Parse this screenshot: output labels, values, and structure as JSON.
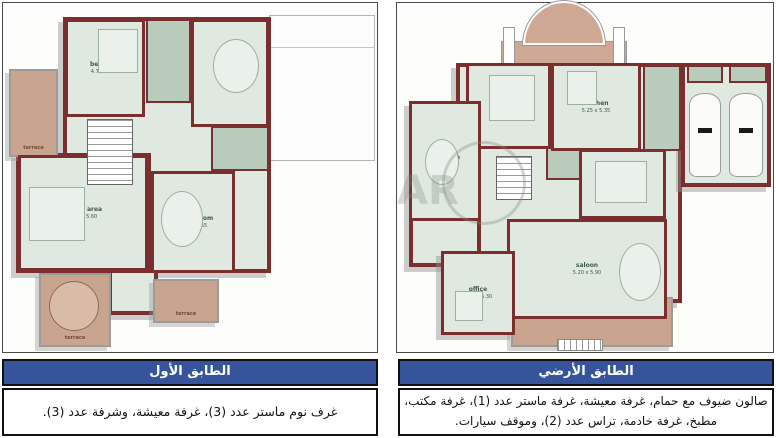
{
  "colors": {
    "header_blue": "#35549b",
    "wall_maroon": "#7a2e2e",
    "room_fill_green": "#dfe9df",
    "terrace_brown": "#c9a58f"
  },
  "watermark": "AR",
  "panels": [
    {
      "id": "first-floor",
      "caption_title": "الطابق الأول",
      "caption_body": "غرف نوم ماستر عدد (3)، غرفة معيشة، وشرفة عدد (3).",
      "plan": {
        "shapes": [
          {
            "t": "outline",
            "name": "garage-roof-outline",
            "x": 266,
            "y": 12,
            "w": 106,
            "h": 146
          },
          {
            "t": "line",
            "name": "roof-line",
            "x": 266,
            "y": 44,
            "w": 106,
            "h": 1
          },
          {
            "t": "block",
            "name": "house-main-block",
            "x": 60,
            "y": 14,
            "w": 208,
            "h": 256
          },
          {
            "t": "block",
            "name": "family-wing-block",
            "x": 13,
            "y": 150,
            "w": 135,
            "h": 120
          },
          {
            "t": "block",
            "name": "bottom-hall-block",
            "x": 105,
            "y": 266,
            "w": 50,
            "h": 46
          },
          {
            "t": "terrace",
            "name": "terrace-left",
            "x": 6,
            "y": 66,
            "w": 49,
            "h": 88,
            "label": "terrace"
          },
          {
            "t": "terrace",
            "name": "terrace-bottom-left",
            "x": 36,
            "y": 270,
            "w": 72,
            "h": 74,
            "label": "terrace"
          },
          {
            "t": "furn-round",
            "name": "terrace-round-table",
            "x": 46,
            "y": 278,
            "w": 50,
            "h": 50
          },
          {
            "t": "terrace",
            "name": "terrace-bottom-center",
            "x": 150,
            "y": 276,
            "w": 66,
            "h": 44,
            "label": "terrace"
          },
          {
            "t": "zone",
            "name": "bathroom-top",
            "x": 143,
            "y": 16,
            "w": 45,
            "h": 84
          },
          {
            "t": "zone",
            "name": "bathroom-right",
            "x": 208,
            "y": 123,
            "w": 58,
            "h": 45
          },
          {
            "t": "room",
            "name": "bedroom-1",
            "x": 62,
            "y": 16,
            "w": 80,
            "h": 98,
            "label": "bedroom",
            "dims": "4.70 x 5.40"
          },
          {
            "t": "room",
            "name": "bedroom-2",
            "x": 188,
            "y": 16,
            "w": 78,
            "h": 108,
            "label": "bedroom",
            "dims": "3.80 x 4.85"
          },
          {
            "t": "room",
            "name": "family-area",
            "x": 15,
            "y": 152,
            "w": 130,
            "h": 116,
            "label": "family area",
            "dims": "4.80 x 5.60"
          },
          {
            "t": "room",
            "name": "master-bedroom",
            "x": 148,
            "y": 168,
            "w": 84,
            "h": 102,
            "label": "M. bedroom",
            "dims": "4.70 x 5.55"
          },
          {
            "t": "furn",
            "name": "bed-1",
            "x": 95,
            "y": 26,
            "w": 40,
            "h": 44
          },
          {
            "t": "furn-oval",
            "name": "bed-2",
            "x": 210,
            "y": 36,
            "w": 46,
            "h": 54
          },
          {
            "t": "furn",
            "name": "family-rug",
            "x": 26,
            "y": 184,
            "w": 56,
            "h": 54
          },
          {
            "t": "furn-oval",
            "name": "master-bed",
            "x": 158,
            "y": 188,
            "w": 42,
            "h": 56
          },
          {
            "t": "stairs",
            "name": "staircase",
            "x": 84,
            "y": 116,
            "w": 46,
            "h": 66
          }
        ]
      }
    },
    {
      "id": "ground-floor",
      "caption_title": "الطابق الأرضي",
      "caption_body": "صالون ضيوف مع حمام، غرفة معيشة، غرفة ماستر عدد (1)، غرفة مكتب، مطبخ، غرفة خادمة، تراس عدد (2)، وموقف سيارات.",
      "plan": {
        "shapes": [
          {
            "t": "arch",
            "name": "entrance-arch",
            "x": 104,
            "y": 6,
            "w": 126,
            "h": 56
          },
          {
            "t": "block",
            "name": "house-main-block",
            "x": 59,
            "y": 60,
            "w": 226,
            "h": 240
          },
          {
            "t": "block",
            "name": "left-wing-block",
            "x": 12,
            "y": 98,
            "w": 72,
            "h": 166
          },
          {
            "t": "block",
            "name": "office-block",
            "x": 44,
            "y": 248,
            "w": 74,
            "h": 84
          },
          {
            "t": "block",
            "name": "garage-block",
            "x": 284,
            "y": 60,
            "w": 90,
            "h": 124
          },
          {
            "t": "terrace",
            "name": "terrace-bottom",
            "x": 114,
            "y": 294,
            "w": 162,
            "h": 50
          },
          {
            "t": "steps",
            "name": "front-steps",
            "x": 160,
            "y": 336,
            "w": 46,
            "h": 12
          },
          {
            "t": "zone",
            "name": "garage-strip-1",
            "x": 290,
            "y": 62,
            "w": 36,
            "h": 18
          },
          {
            "t": "zone",
            "name": "garage-strip-2",
            "x": 332,
            "y": 62,
            "w": 38,
            "h": 18
          },
          {
            "t": "zone",
            "name": "bath-center",
            "x": 149,
            "y": 143,
            "w": 40,
            "h": 34
          },
          {
            "t": "zone",
            "name": "maid-room",
            "x": 246,
            "y": 62,
            "w": 38,
            "h": 86
          },
          {
            "t": "room",
            "name": "living",
            "x": 69,
            "y": 60,
            "w": 85,
            "h": 86,
            "label": "living",
            "dims": "4.55 x 5.30"
          },
          {
            "t": "room",
            "name": "kitchen",
            "x": 154,
            "y": 60,
            "w": 90,
            "h": 88,
            "label": "kitchen",
            "dims": "5.25 x 5.35"
          },
          {
            "t": "room",
            "name": "bedroom",
            "x": 12,
            "y": 98,
            "w": 72,
            "h": 120,
            "label": "bedroom",
            "dims": "3.80 x 4.70"
          },
          {
            "t": "room",
            "name": "dining",
            "x": 182,
            "y": 146,
            "w": 87,
            "h": 70,
            "label": "dining",
            "dims": "4.50 x 4.80"
          },
          {
            "t": "room",
            "name": "saloon",
            "x": 110,
            "y": 216,
            "w": 160,
            "h": 100,
            "label": "saloon",
            "dims": "5.20 x 5.90"
          },
          {
            "t": "room",
            "name": "office",
            "x": 44,
            "y": 248,
            "w": 74,
            "h": 84,
            "label": "office",
            "dims": "4.35 x 5.30"
          },
          {
            "t": "furn",
            "name": "living-sofa",
            "x": 92,
            "y": 72,
            "w": 46,
            "h": 46
          },
          {
            "t": "furn",
            "name": "kitchen-counter",
            "x": 170,
            "y": 68,
            "w": 30,
            "h": 34
          },
          {
            "t": "furn-oval",
            "name": "bed",
            "x": 28,
            "y": 136,
            "w": 34,
            "h": 46
          },
          {
            "t": "furn",
            "name": "dining-table",
            "x": 198,
            "y": 158,
            "w": 52,
            "h": 42
          },
          {
            "t": "furn-oval",
            "name": "saloon-seat",
            "x": 222,
            "y": 240,
            "w": 42,
            "h": 58
          },
          {
            "t": "furn",
            "name": "office-desk",
            "x": 58,
            "y": 288,
            "w": 28,
            "h": 30
          },
          {
            "t": "car",
            "name": "car-1",
            "x": 292,
            "y": 90,
            "w": 32,
            "h": 84
          },
          {
            "t": "car",
            "name": "car-2",
            "x": 332,
            "y": 90,
            "w": 34,
            "h": 84
          },
          {
            "t": "stairs",
            "name": "staircase",
            "x": 99,
            "y": 153,
            "w": 36,
            "h": 44
          },
          {
            "t": "wm-circle",
            "name": "watermark-circle",
            "x": 45,
            "y": 138,
            "w": 84,
            "h": 84
          },
          {
            "t": "wm-text",
            "name": "watermark-text",
            "x": 0,
            "y": 168,
            "w": 60,
            "h": 50,
            "label": "AR"
          }
        ]
      }
    }
  ]
}
